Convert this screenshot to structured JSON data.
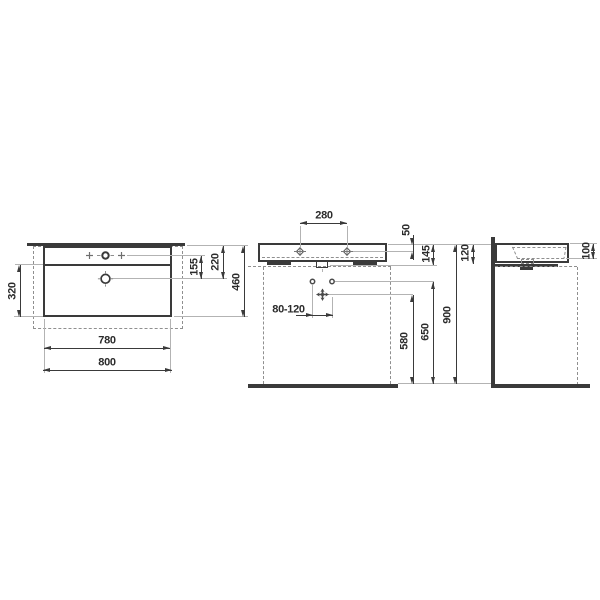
{
  "document": {
    "background": "#ffffff",
    "ink_color": "#3a3a3a",
    "subject": "washbasin-technical-drawing",
    "views": {
      "plan": {
        "dims": {
          "bowl_depth": "320",
          "inner_width": "780",
          "overall_width": "800",
          "tap_to_drain": "155",
          "rear_to_drain": "220",
          "overall_depth": "460"
        }
      },
      "front": {
        "dims": {
          "tap_hole_spacing": "280",
          "rim_to_tap_holes": "50",
          "rim_to_underside": "145",
          "waste_offset_range": "80-120",
          "waste_height": "580",
          "fixing_height": "650",
          "rim_height": "900"
        }
      },
      "side": {
        "dims": {
          "body_height": "120",
          "inner_depth": "100"
        }
      }
    }
  }
}
